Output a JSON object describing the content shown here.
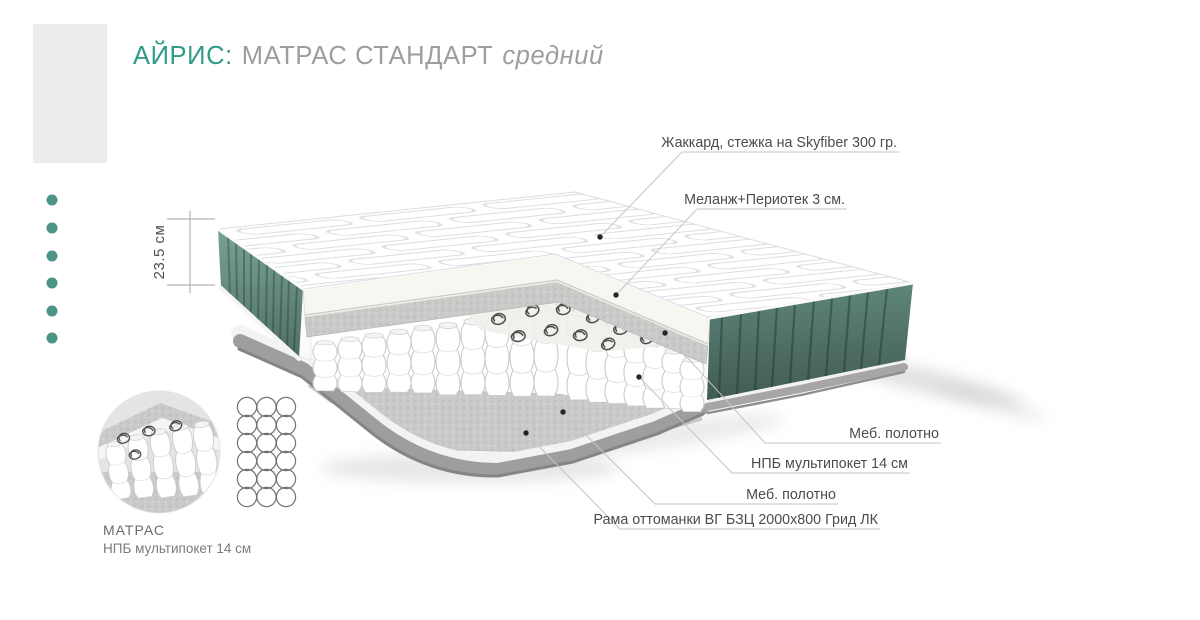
{
  "title": {
    "brand": "АЙРИС:",
    "product": "МАТРАС СТАНДАРТ",
    "variant": "средний"
  },
  "dimension": {
    "height_label": "23.5 см"
  },
  "callouts": {
    "top": [
      {
        "label": "Жаккард, стежка на Skyfiber 300 гр."
      },
      {
        "label": "Меланж+Периотек 3 см."
      }
    ],
    "bottom": [
      {
        "label": "Меб. полотно"
      },
      {
        "label": "НПБ мультипокет 14 см"
      },
      {
        "label": "Меб. полотно"
      },
      {
        "label": "Рама оттоманки ВГ БЗЦ 2000х800 Грид ЛК"
      }
    ]
  },
  "detail": {
    "title": "МАТРАС",
    "subtitle": "НПБ мультипокет 14 см"
  },
  "colors": {
    "accent": "#2f9b87",
    "title_gray": "#9b9ea0",
    "label": "#4c4c4c",
    "line": "#c4c4c4",
    "bullet": "#4b9486",
    "teal_side": "#5d8378",
    "frame_gray": "#9e9e9e"
  }
}
